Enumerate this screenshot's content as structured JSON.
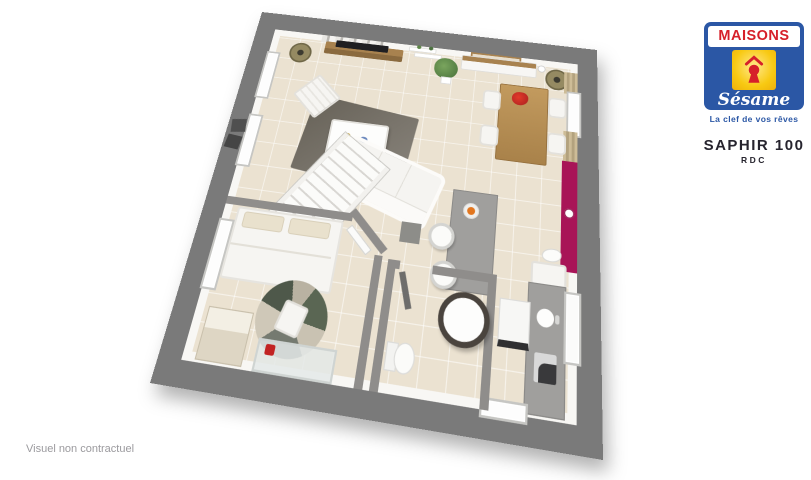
{
  "brand": {
    "name": "MAISONS",
    "subname": "Sésame",
    "tagline": "La clef de vos rêves"
  },
  "plan": {
    "title": "SAPHIR 100",
    "level": "RDC"
  },
  "footer": {
    "disclaimer": "Visuel non contractuel"
  },
  "colors": {
    "brandBlue": "#2b57a5",
    "brandRed": "#d6202a",
    "brandYellow": "#f8c912",
    "accentMagenta": "#a81457",
    "borderGray": "#7a7a7a",
    "wallGray": "#8f8d8b",
    "floorBeige": "#ebe2d1",
    "wood": "#b98d52",
    "rugDark": "#676258",
    "lampOlive": "#8d7f58",
    "plantGreen": "#5e8748",
    "orangeDish": "#e2761f",
    "titleDark": "#26242e",
    "disclaimerGray": "#9b9a9e"
  }
}
